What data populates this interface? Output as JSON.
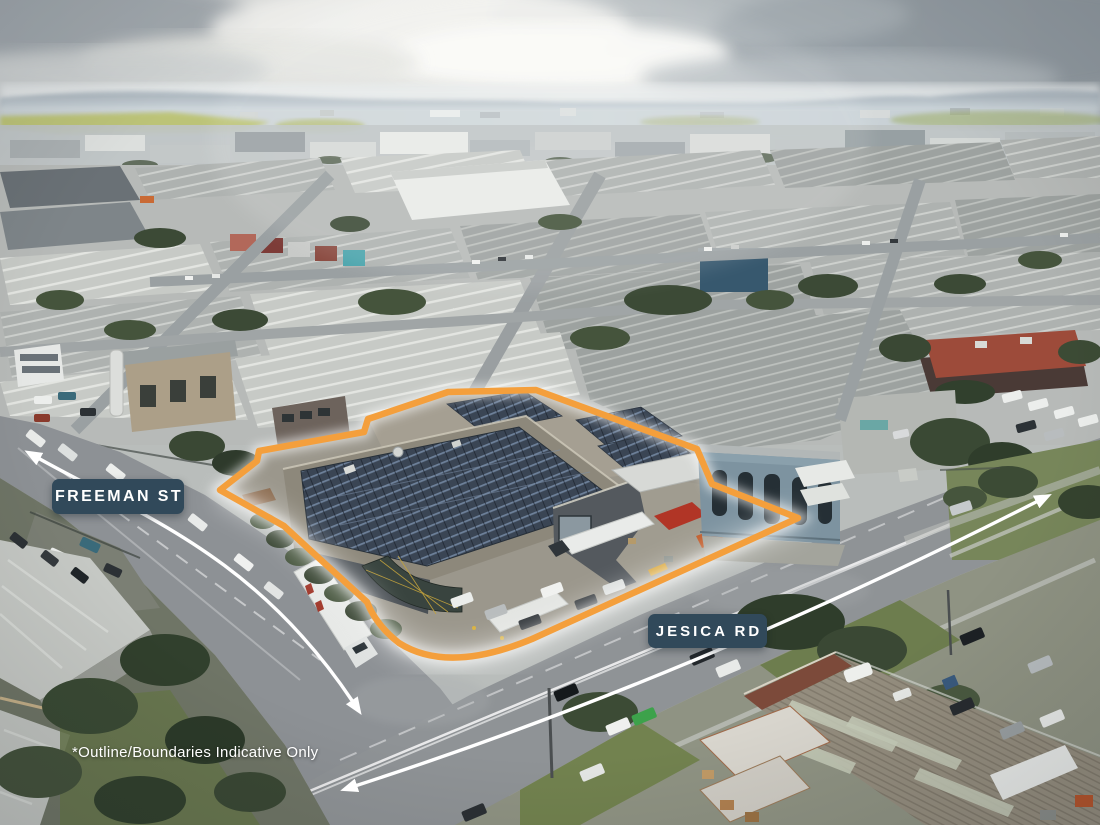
{
  "image": {
    "kind": "aerial-drone-photograph",
    "scene": "Industrial precinct; subject warehouse property with rooftop solar outlined in orange at the corner of Freeman St and Jesica Rd",
    "width_px": 1100,
    "height_px": 825
  },
  "annotations": {
    "street_labels": [
      {
        "text": "FREEMAN ST"
      },
      {
        "text": "JESICA RD"
      }
    ],
    "disclaimer": "*Outline/Boundaries Indicative Only",
    "boundary": {
      "color": "#F49F3C",
      "shape": "indicative property outline polygon"
    },
    "arrows": {
      "color": "#FFFFFF",
      "style": "double-headed street continuation arrows",
      "count": 2
    }
  },
  "colors": {
    "boundary_orange": "#F49F3C",
    "label_background": "#31495A",
    "label_text": "#FFFFFF",
    "arrow": "#FFFFFF",
    "disclaimer_text": "#FFFFFF",
    "sky_grey": "#CDD3D6",
    "asphalt": "#8E9295",
    "solar_panel": "#3B4757"
  }
}
